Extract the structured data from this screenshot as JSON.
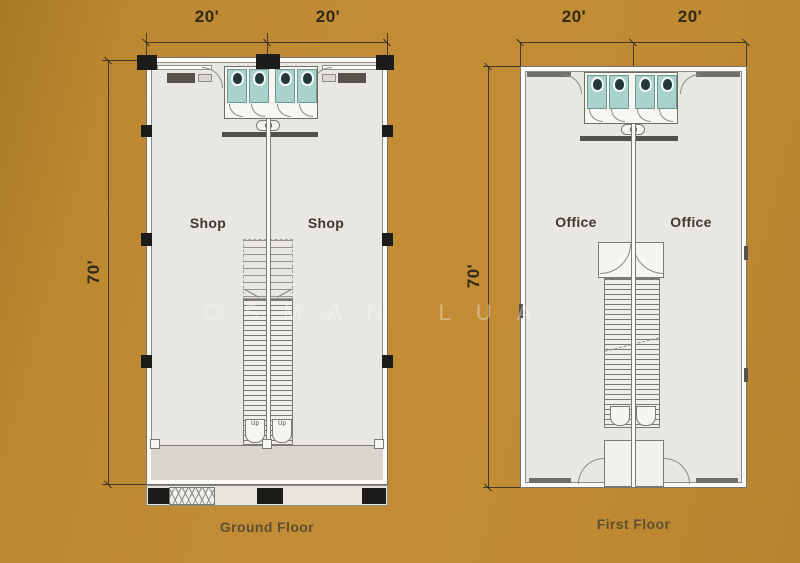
{
  "watermark": "CSMAN LUA",
  "colors": {
    "background": "#bf8a32",
    "plan_floor": "#e9e7e1",
    "walkway": "#d7d5ce",
    "toilet_floor": "#a9d2ca",
    "column": "#1d1c1a",
    "drawing_line": "#8d8b85",
    "dimension_text": "#33291a",
    "caption_text": "#5f4e32"
  },
  "ground_floor": {
    "caption": "Ground Floor",
    "dim_width_left": "20'",
    "dim_width_right": "20'",
    "dim_height": "70'",
    "unit_left": "Shop",
    "unit_right": "Shop",
    "stair_up_left": "Up",
    "stair_up_right": "Up"
  },
  "first_floor": {
    "caption": "First Floor",
    "dim_width_left": "20'",
    "dim_width_right": "20'",
    "dim_height": "70'",
    "unit_left": "Office",
    "unit_right": "Office"
  }
}
